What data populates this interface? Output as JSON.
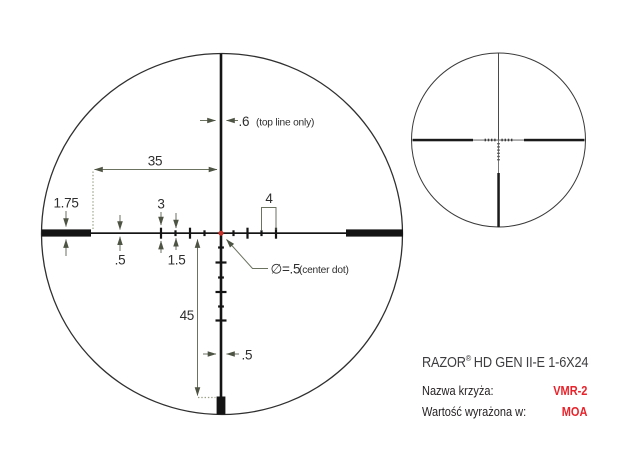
{
  "colors": {
    "reticle_black": "#141414",
    "dimension_olive": "#6b7260",
    "arrow_dark": "#4e5444",
    "center_dot_red": "#c9302a",
    "annotation_text": "#2e2e2e",
    "title_gray": "#3d3d40",
    "label_black": "#231f20",
    "value_red": "#e8232b"
  },
  "detail_view": {
    "dim_35": "35",
    "dim_175": "1.75",
    "dim_05_left": ".5",
    "dim_3": "3",
    "dim_15": "1.5",
    "dim_4": "4",
    "dim_06": ".6",
    "dim_06_note": "(top line only)",
    "center_dot": "∅=.5",
    "center_dot_note": "(center dot)",
    "dim_45": "45",
    "dim_05_bottom": ".5"
  },
  "info_panel": {
    "title_brand": "RAZOR",
    "title_reg": "®",
    "title_model": "HD GEN II-E 1-6X24",
    "rows": [
      {
        "label": "Nazwa krzyża:",
        "value": "VMR-2"
      },
      {
        "label": "Wartość wyrażona w:",
        "value": "MOA"
      }
    ]
  }
}
